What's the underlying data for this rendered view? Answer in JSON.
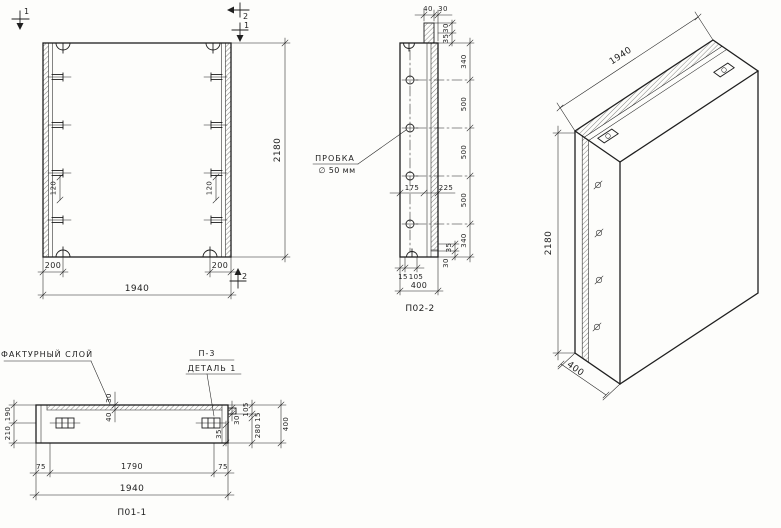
{
  "colors": {
    "paper": "#fdfdfb",
    "ink": "#1f1f1f"
  },
  "front_view": {
    "section_marks": {
      "top_left": "1",
      "top_right_outer": "2",
      "top_right_inner": "1",
      "bottom_right": "2"
    },
    "dim_height": "2180",
    "dim_width_total": "1940",
    "dim_end_left": "200",
    "dim_end_right": "200",
    "dim_anchor_left": "120",
    "dim_anchor_right": "120"
  },
  "section_2_2": {
    "label": "П02-2",
    "dim_top_tongue": "40",
    "dim_top_layer": "30",
    "top_small": [
      "30",
      "35"
    ],
    "right_chain": [
      "340",
      "500",
      "500",
      "500",
      "340"
    ],
    "bottom_small": [
      "35",
      "30"
    ],
    "dim_mid_left": "175",
    "dim_mid_right": "225",
    "dim_bottom_a": "15",
    "dim_bottom_b": "105",
    "dim_bottom_total": "400",
    "plug_callout_line1": "ПРОБКА",
    "plug_callout_line2": "∅ 50 мм"
  },
  "section_1_1": {
    "label": "П01-1",
    "layer_callout": "ФАКТУРНЫЙ СЛОЙ",
    "detail_callout_line1": "П-3",
    "detail_callout_line2": "ДЕТАЛЬ 1",
    "dim_layer_top": "30",
    "dim_layer_bottom": "40",
    "left_chain": [
      "190",
      "210"
    ],
    "dim_detail_a": "30",
    "dim_detail_b": "35",
    "right_chain": [
      "105",
      "15",
      "280"
    ],
    "dim_right_total": "400",
    "bottom_chain": [
      "75",
      "1790",
      "75"
    ],
    "dim_bottom_total": "1940"
  },
  "isometric": {
    "dim_length": "1940",
    "dim_height": "2180",
    "dim_width": "400"
  }
}
